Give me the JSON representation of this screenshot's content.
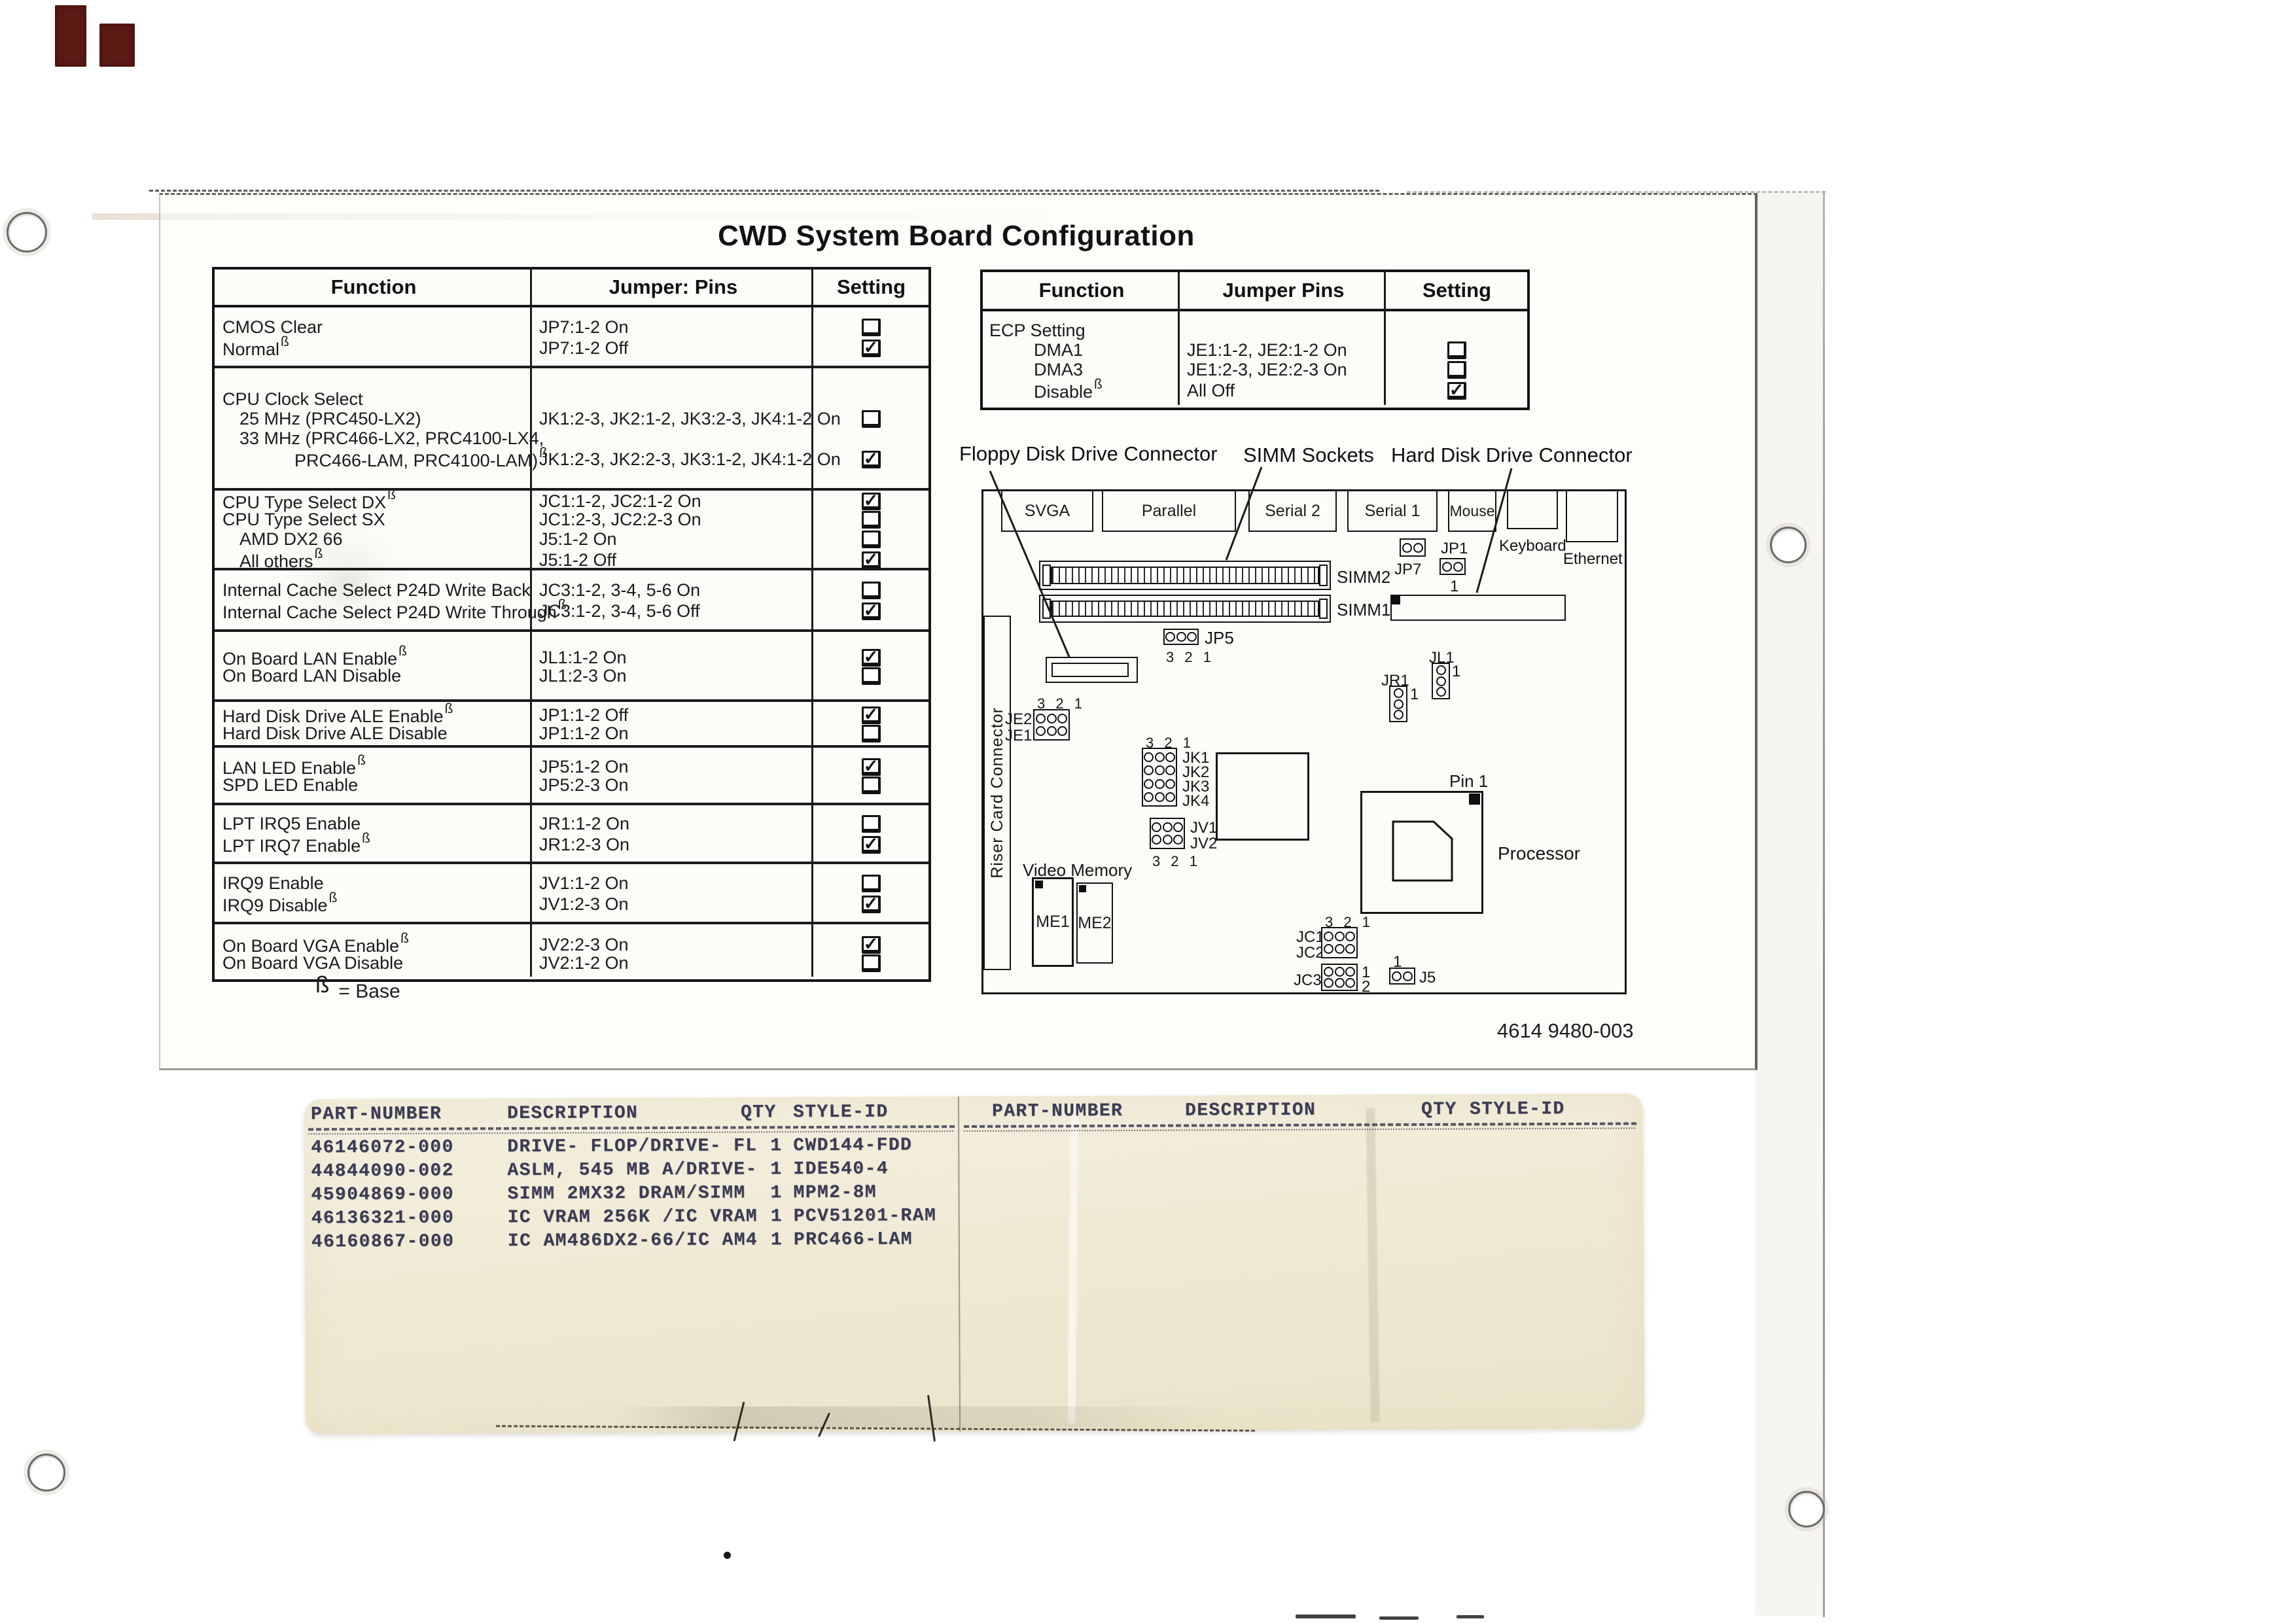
{
  "title": "CWD System Board Configuration",
  "doc_number": "4614 9480-003",
  "legend": {
    "symbol": "ß",
    "text": "=  Base"
  },
  "left_table": {
    "headers": [
      "Function",
      "Jumper: Pins",
      "Setting"
    ],
    "sections": [
      {
        "lines": [
          {
            "f": "CMOS Clear",
            "j": "JP7:1-2 On",
            "s": "unchecked"
          },
          {
            "f": "Normal",
            "sup": true,
            "j": "JP7:1-2 Off",
            "s": "checked"
          }
        ]
      },
      {
        "lines": [
          {
            "f": "CPU Clock Select"
          },
          {
            "f": "25 MHz (PRC450-LX2)",
            "indent": 1,
            "j": "JK1:2-3, JK2:1-2, JK3:2-3, JK4:1-2 On",
            "s": "unchecked"
          },
          {
            "f": "33 MHz (PRC466-LX2, PRC4100-LX4,",
            "indent": 1
          },
          {
            "f": "PRC466-LAM, PRC4100-LAM)",
            "indent": 2,
            "sup": true,
            "j": "JK1:2-3, JK2:2-3, JK3:1-2, JK4:1-2 On",
            "s": "checked"
          }
        ]
      },
      {
        "lines": [
          {
            "f": "CPU Type Select DX",
            "sup": true,
            "j": "JC1:1-2, JC2:1-2 On",
            "s": "checked"
          },
          {
            "f": "CPU Type Select SX",
            "j": "JC1:2-3, JC2:2-3 On",
            "s": "unchecked"
          },
          {
            "f": "AMD DX2 66",
            "indent": 1,
            "j": "J5:1-2 On",
            "s": "unchecked"
          },
          {
            "f": "All others",
            "indent": 1,
            "sup": true,
            "j": "J5:1-2 Off",
            "s": "checked"
          }
        ]
      },
      {
        "lines": [
          {
            "f": "Internal Cache Select P24D Write Back",
            "j": "JC3:1-2, 3-4, 5-6 On",
            "s": "unchecked"
          },
          {
            "f": "Internal Cache Select P24D Write Through",
            "sup": true,
            "j": "JC3:1-2, 3-4, 5-6 Off",
            "s": "checked"
          }
        ]
      },
      {
        "lines": [
          {
            "f": "On Board LAN Enable",
            "sup": true,
            "j": "JL1:1-2 On",
            "s": "checked"
          },
          {
            "f": "On Board LAN Disable",
            "j": "JL1:2-3 On",
            "s": "unchecked"
          }
        ]
      },
      {
        "lines": [
          {
            "f": "Hard Disk Drive ALE Enable",
            "sup": true,
            "j": "JP1:1-2 Off",
            "s": "checked"
          },
          {
            "f": "Hard Disk Drive ALE Disable",
            "j": "JP1:1-2 On",
            "s": "unchecked"
          }
        ]
      },
      {
        "lines": [
          {
            "f": "LAN LED Enable",
            "sup": true,
            "j": "JP5:1-2 On",
            "s": "checked"
          },
          {
            "f": "SPD LED Enable",
            "j": "JP5:2-3 On",
            "s": "unchecked"
          }
        ]
      },
      {
        "lines": [
          {
            "f": "LPT IRQ5 Enable",
            "j": "JR1:1-2 On",
            "s": "unchecked"
          },
          {
            "f": "LPT IRQ7 Enable",
            "sup": true,
            "j": "JR1:2-3 On",
            "s": "checked"
          }
        ]
      },
      {
        "lines": [
          {
            "f": "IRQ9 Enable",
            "j": "JV1:1-2 On",
            "s": "unchecked"
          },
          {
            "f": "IRQ9 Disable",
            "sup": true,
            "j": "JV1:2-3 On",
            "s": "checked"
          }
        ]
      },
      {
        "lines": [
          {
            "f": "On Board VGA Enable",
            "sup": true,
            "j": "JV2:2-3 On",
            "s": "checked"
          },
          {
            "f": "On Board VGA Disable",
            "j": "JV2:1-2 On",
            "s": "unchecked"
          }
        ]
      }
    ]
  },
  "right_table": {
    "headers": [
      "Function",
      "Jumper Pins",
      "Setting"
    ],
    "sections": [
      {
        "lines": [
          {
            "f": "ECP Setting"
          },
          {
            "f": "DMA1",
            "indent": 1,
            "j": "JE1:1-2, JE2:1-2 On",
            "s": "unchecked"
          },
          {
            "f": "DMA3",
            "indent": 1,
            "j": "JE1:2-3, JE2:2-3 On",
            "s": "unchecked"
          },
          {
            "f": "Disable",
            "indent": 1,
            "sup": true,
            "j": "All Off",
            "s": "checked"
          }
        ]
      }
    ]
  },
  "board": {
    "callouts": {
      "floppy": "Floppy Disk Drive Connector",
      "simm": "SIMM Sockets",
      "hdd": "Hard Disk Drive Connector"
    },
    "ports": [
      "SVGA",
      "Parallel",
      "Serial 2",
      "Serial 1",
      "Mouse"
    ],
    "keyboard": "Keyboard",
    "ethernet": "Ethernet",
    "riser": "Riser Card Connector",
    "video_memory": "Video Memory",
    "processor": "Processor",
    "pin1": "Pin 1",
    "slots": {
      "simm1": "SIMM1",
      "simm2": "SIMM2"
    },
    "chips": {
      "me1": "ME1",
      "me2": "ME2"
    },
    "jumpers": {
      "jp7": "JP7",
      "jp1": "JP1",
      "jp5": "JP5",
      "je2": "JE2",
      "je1": "JE1",
      "jk1": "JK1",
      "jk2": "JK2",
      "jk3": "JK3",
      "jk4": "JK4",
      "jv1": "JV1",
      "jv2": "JV2",
      "jr1": "JR1",
      "jl1": "JL1",
      "jc1": "JC1",
      "jc2": "JC2",
      "jc3": "JC3",
      "j5": "J5"
    },
    "pins": {
      "seq": "3 2 1",
      "one": "1",
      "two": "2"
    }
  },
  "sticker": {
    "headers": [
      "PART-NUMBER",
      "DESCRIPTION",
      "QTY",
      "STYLE-ID"
    ],
    "rows": [
      [
        "46146072-000",
        "DRIVE- FLOP/DRIVE- FL",
        "1",
        "CWD144-FDD"
      ],
      [
        "44844090-002",
        "ASLM, 545 MB A/DRIVE-",
        "1",
        "IDE540-4"
      ],
      [
        "45904869-000",
        "SIMM 2MX32 DRAM/SIMM",
        "1",
        "MPM2-8M"
      ],
      [
        "46136321-000",
        "IC VRAM 256K /IC VRAM",
        "1",
        "PCV51201-RAM"
      ],
      [
        "46160867-000",
        "IC AM486DX2-66/IC AM4",
        "1",
        "PRC466-LAM"
      ]
    ]
  }
}
